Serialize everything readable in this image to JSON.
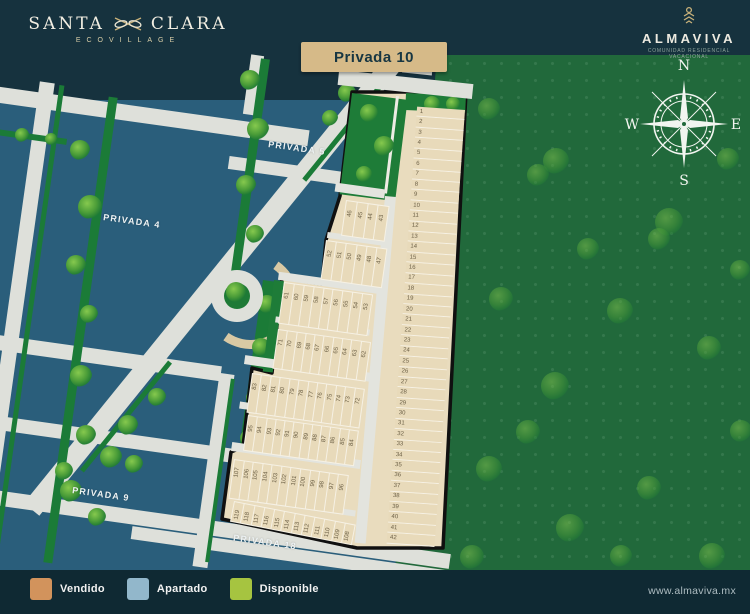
{
  "header": {
    "santa_clara": {
      "word1": "SANTA",
      "word2": "CLARA",
      "subtitle": "ECOVILLAGE"
    },
    "almaviva": {
      "name": "ALMAVIVA",
      "tagline": "COMUNIDAD RESIDENCIAL VACACIONAL"
    },
    "badge": "Privada 10"
  },
  "map": {
    "street_labels": {
      "privada5": "PRIVADA 5",
      "privada4": "PRIVADA 4",
      "privada9": "PRIVADA 9",
      "privada18": "PRIVADA 18"
    },
    "compass": {
      "north": "N",
      "east": "E",
      "south": "S",
      "west": "W"
    }
  },
  "privada": {
    "right_column": [
      "1",
      "2",
      "3",
      "4",
      "5",
      "6",
      "7",
      "8",
      "9",
      "10",
      "11",
      "12",
      "13",
      "14",
      "15",
      "16",
      "17",
      "18",
      "19",
      "20",
      "21",
      "22",
      "23",
      "24",
      "25",
      "26",
      "27",
      "28",
      "29",
      "30",
      "31",
      "32",
      "33",
      "34",
      "35",
      "36",
      "37",
      "38",
      "39",
      "40",
      "41",
      "42"
    ],
    "row_a1": [
      "46",
      "45",
      "44",
      "43"
    ],
    "row_a2": [
      "52",
      "51",
      "50",
      "49",
      "48",
      "47"
    ],
    "row_b1": [
      "61",
      "60",
      "59",
      "58",
      "57",
      "56",
      "55",
      "54",
      "53"
    ],
    "row_b2": [
      "71",
      "70",
      "69",
      "68",
      "67",
      "66",
      "65",
      "64",
      "63",
      "62"
    ],
    "row_c1": [
      "83",
      "82",
      "81",
      "80",
      "79",
      "78",
      "77",
      "76",
      "75",
      "74",
      "73",
      "72"
    ],
    "row_c2": [
      "95",
      "94",
      "93",
      "92",
      "91",
      "90",
      "89",
      "88",
      "87",
      "86",
      "85",
      "84"
    ],
    "row_d1": [
      "107",
      "106",
      "105",
      "104",
      "103",
      "102",
      "101",
      "100",
      "99",
      "98",
      "97",
      "96"
    ],
    "row_d2": [
      "119",
      "118",
      "117",
      "116",
      "115",
      "114",
      "113",
      "112",
      "111",
      "110",
      "109",
      "108"
    ]
  },
  "legend": {
    "items": [
      {
        "label": "Vendido",
        "color": "#D2935C"
      },
      {
        "label": "Apartado",
        "color": "#92B7CB"
      },
      {
        "label": "Disponible",
        "color": "#A6C440"
      }
    ]
  },
  "footer": {
    "website": "www.almaviva.mx"
  },
  "colors": {
    "background": "#16323E",
    "block_blue": "#2A5E7B",
    "street_gray": "#DEE0DA",
    "forest_green": "#21693B",
    "lot_beige": "#E8DABA",
    "badge_tan": "#D6BA88",
    "boundary_black": "#101010"
  }
}
